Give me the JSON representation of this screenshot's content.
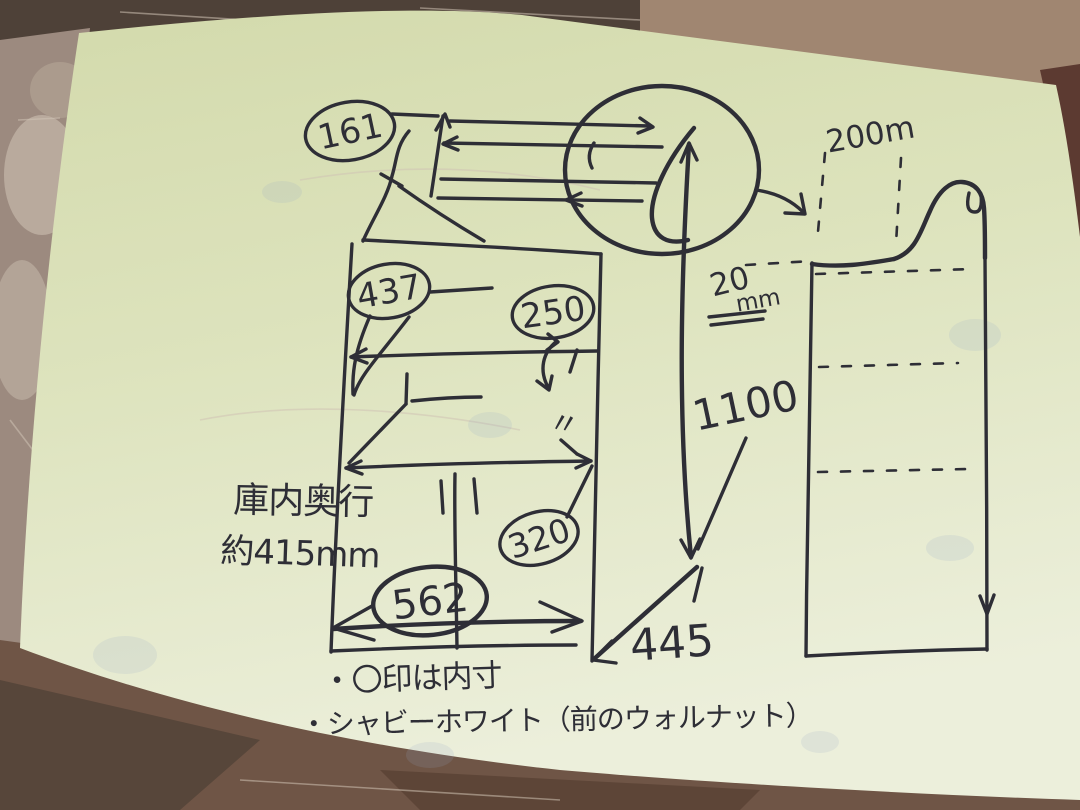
{
  "colors": {
    "ink": "#2e2e36",
    "paper_top": "#d3daac",
    "paper_mid": "#dde3bd",
    "paper_bottom": "#ecefdb",
    "wood_dark": "#4e4138",
    "wood_mid": "#7d6452",
    "wood_pink": "#a08671",
    "wood_maroon": "#5c3a31"
  },
  "labels": {
    "dim_161": "161",
    "dim_437": "437",
    "dim_250": "250",
    "dim_320": "320",
    "dim_562": "562",
    "dim_1100": "1100",
    "dim_445": "445",
    "dim_200m": "200m",
    "dim_20": "20",
    "unit_mm": "mm",
    "ditto_mark": "〃",
    "depth_label": "庫内奥行",
    "depth_value": "約415mm",
    "note_inner": "・〇印は内寸",
    "note_color": "・シャビーホワイト（前のウォルナット）"
  }
}
